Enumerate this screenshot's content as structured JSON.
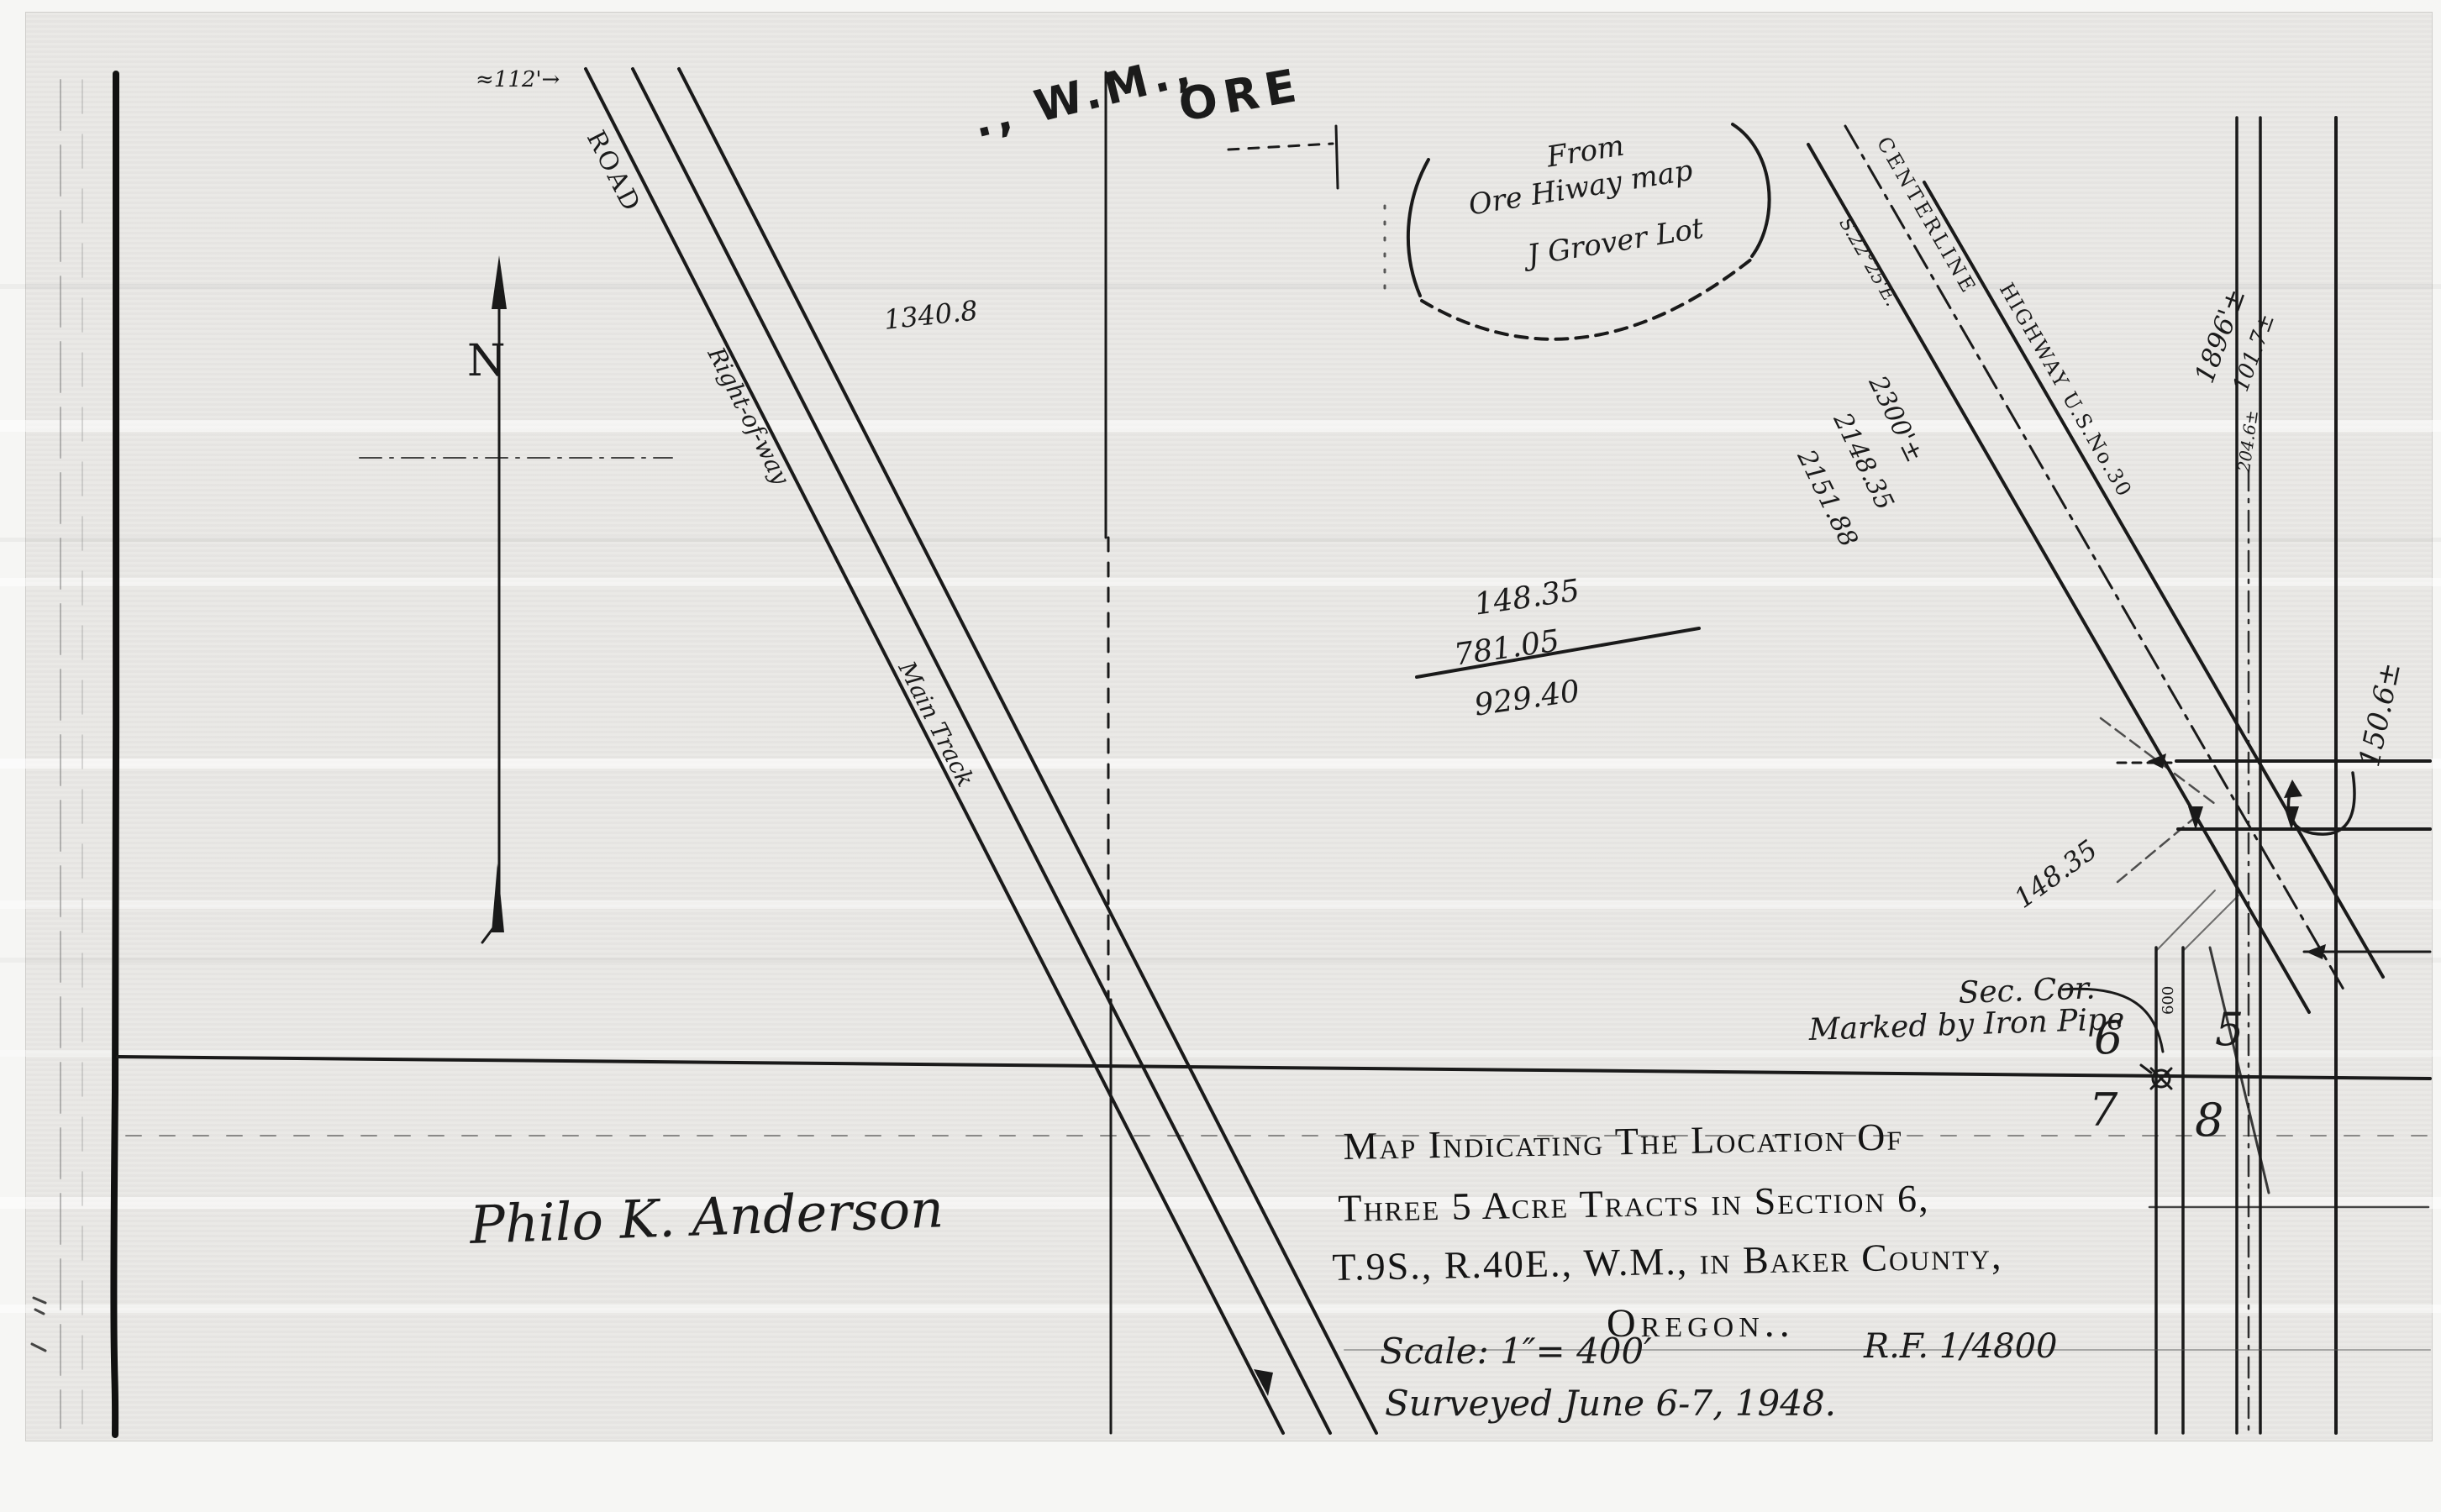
{
  "header": {
    "wm": "., W.M.,",
    "ore": "ORE"
  },
  "compass": {
    "label": "N"
  },
  "roads": {
    "width_note": "≈112'→",
    "road_label": "ROAD",
    "right_of_way": "Right-of-way",
    "main_track": "Main Track"
  },
  "highway": {
    "centerline": "CENTERLINE",
    "name": "HIGHWAY U.S.No.30",
    "bearing": "S.22°25'E."
  },
  "note_bubble": {
    "line1": "From",
    "line2": "Ore Hiway map",
    "line3": "J Grover Lot"
  },
  "measurements": {
    "d1340": "1340.8",
    "sum": [
      "148.35",
      "781.05",
      "929.40"
    ],
    "stack": [
      "2300'±",
      "2148.35",
      "2151.88"
    ],
    "d148_diagonal": "148.35",
    "d150": "150.6±",
    "d1896": "1896'±",
    "d101": "101.7±",
    "d204": "204.6±",
    "d600": "600"
  },
  "section_corner": {
    "label_line1": "Sec. Cor.",
    "label_line2": "Marked by Iron Pipe",
    "sections": {
      "nw": "6",
      "ne": "5",
      "sw": "7",
      "se": "8"
    }
  },
  "title_block": {
    "line1": "Map Indicating The Location Of",
    "line2": "Three 5 Acre Tracts in Section 6,",
    "line3": "T.9S., R.40E., W.M., in Baker County,",
    "line4": "Oregon..",
    "scale": "Scale: 1″= 400′",
    "rf": "R.F. 1/4800",
    "surveyed": "Surveyed June 6-7, 1948."
  },
  "signature": "Philo K. Anderson"
}
